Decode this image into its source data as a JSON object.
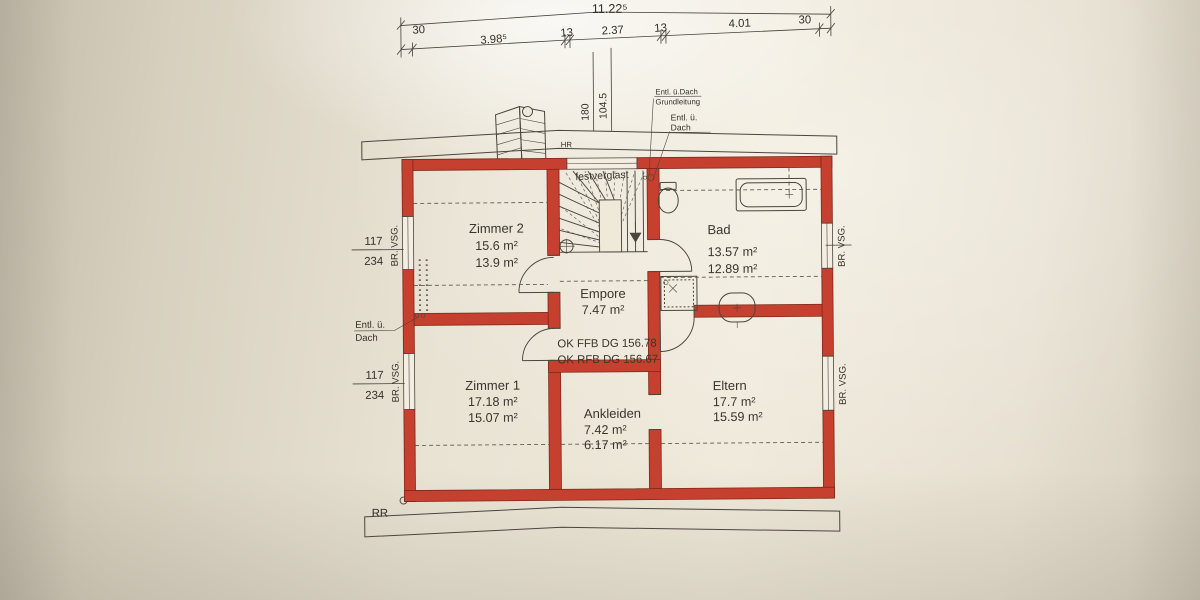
{
  "dims": {
    "overall": "11.22⁵",
    "seg": [
      "30",
      "3.98⁵",
      "13",
      "2.37",
      "13",
      "4.01",
      "30"
    ],
    "v1": "180",
    "v2": "104.5"
  },
  "rooms": {
    "zimmer2": {
      "name": "Zimmer 2",
      "a1": "15.6 m²",
      "a2": "13.9 m²"
    },
    "bad": {
      "name": "Bad",
      "a1": "13.57 m²",
      "a2": "12.89 m²"
    },
    "empore": {
      "name": "Empore",
      "a1": "7.47 m²"
    },
    "zimmer1": {
      "name": "Zimmer 1",
      "a1": "17.18 m²",
      "a2": "15.07 m²"
    },
    "ankleiden": {
      "name": "Ankleiden",
      "a1": "7.42 m²",
      "a2": "6.17 m²"
    },
    "eltern": {
      "name": "Eltern",
      "a1": "17.7 m²",
      "a2": "15.59 m²"
    }
  },
  "levels": {
    "ffb": "OK FFB DG 156.78",
    "rfb": "OK RFB DG 156.67"
  },
  "ann": {
    "festverglast": "festverglast",
    "entl_grund_1": "Entl. ü.Dach",
    "entl_grund_2": "Grundleitung",
    "entl_top_1": "Entl. ü.",
    "entl_top_2": "Dach",
    "entl_left_1": "Entl. ü.",
    "entl_left_2": "Dach",
    "rr": "RR",
    "hr": "HR",
    "win_num": "117",
    "win_den": "234",
    "brvsg": "BR. VSG."
  },
  "colors": {
    "wall": "#c5402e",
    "paper": "#e8e2d3",
    "line": "#3f3b33"
  }
}
